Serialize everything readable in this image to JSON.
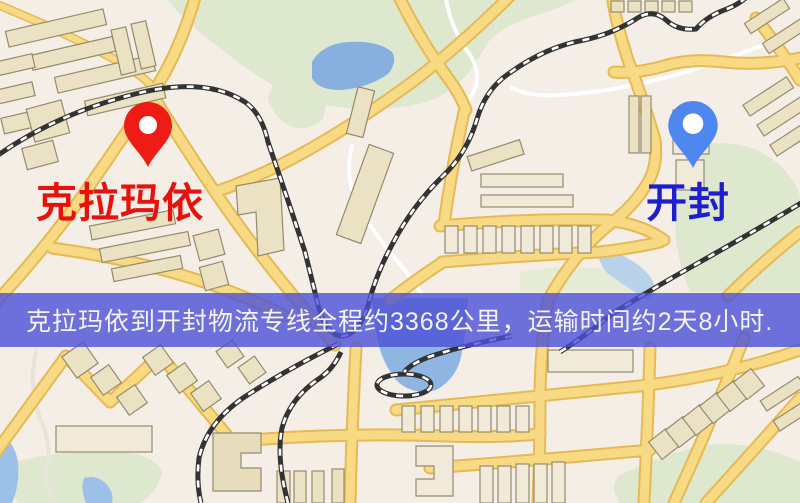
{
  "map": {
    "origin": {
      "label": "克拉玛依",
      "pin_color": "#ee1c14",
      "label_color": "#e8120c"
    },
    "destination": {
      "label": "开封",
      "pin_color": "#4f87f0",
      "label_color": "#1e1ecf"
    },
    "banner": {
      "text": "克拉玛依到开封物流专线全程约3368公里，运输时间约2天8小时.",
      "distance_text": "3368公里",
      "duration_text": "2天8小时",
      "background": "#4b50d7",
      "text_color": "#f4f4ec"
    }
  },
  "palette": {
    "map_background": "#f4eee6",
    "park_green": "#dde8cf",
    "water_blue": "#87b0de",
    "road_fill": "#f8da85",
    "road_casing": "#e5ba55",
    "building_fill": "#ebe1c3",
    "building_stroke": "#948b6e",
    "railway_black": "#333333",
    "minor_road_white": "#ffffff"
  }
}
